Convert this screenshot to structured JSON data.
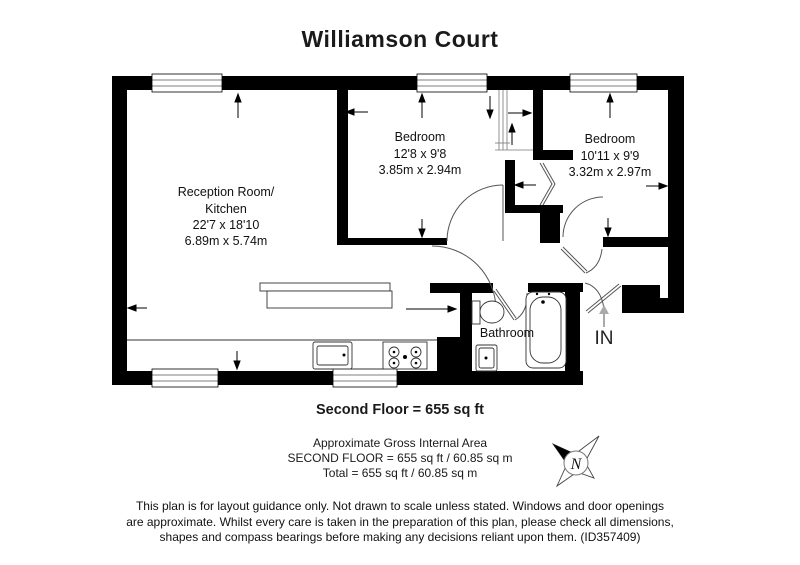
{
  "title": "Williamson Court",
  "rooms": {
    "reception": {
      "name_line1": "Reception Room/",
      "name_line2": "Kitchen",
      "imperial": "22'7 x 18'10",
      "metric": "6.89m x 5.74m"
    },
    "bedroom1": {
      "name": "Bedroom",
      "imperial": "12'8 x 9'8",
      "metric": "3.85m x 2.94m"
    },
    "bedroom2": {
      "name": "Bedroom",
      "imperial": "10'11 x 9'9",
      "metric": "3.32m x 2.97m"
    },
    "bathroom": {
      "name": "Bathroom"
    }
  },
  "entrance_label": "IN",
  "compass_label": "N",
  "floor_summary": "Second Floor = 655 sq ft",
  "area_note": {
    "line1": "Approximate Gross Internal Area",
    "line2": "SECOND FLOOR = 655 sq ft / 60.85 sq m",
    "line3": "Total = 655 sq ft / 60.85 sq m"
  },
  "disclaimer": {
    "line1": "This plan is for layout guidance only. Not drawn to scale unless stated. Windows and door openings",
    "line2": "are approximate. Whilst every care is taken in the preparation of this plan, please check all dimensions,",
    "line3": "shapes and compass bearings before making any decisions reliant upon them. (ID357409)"
  },
  "colors": {
    "walls": "#000000",
    "background": "#ffffff",
    "door_lines": "#555555",
    "entry_arrow": "#aaaaaa"
  }
}
